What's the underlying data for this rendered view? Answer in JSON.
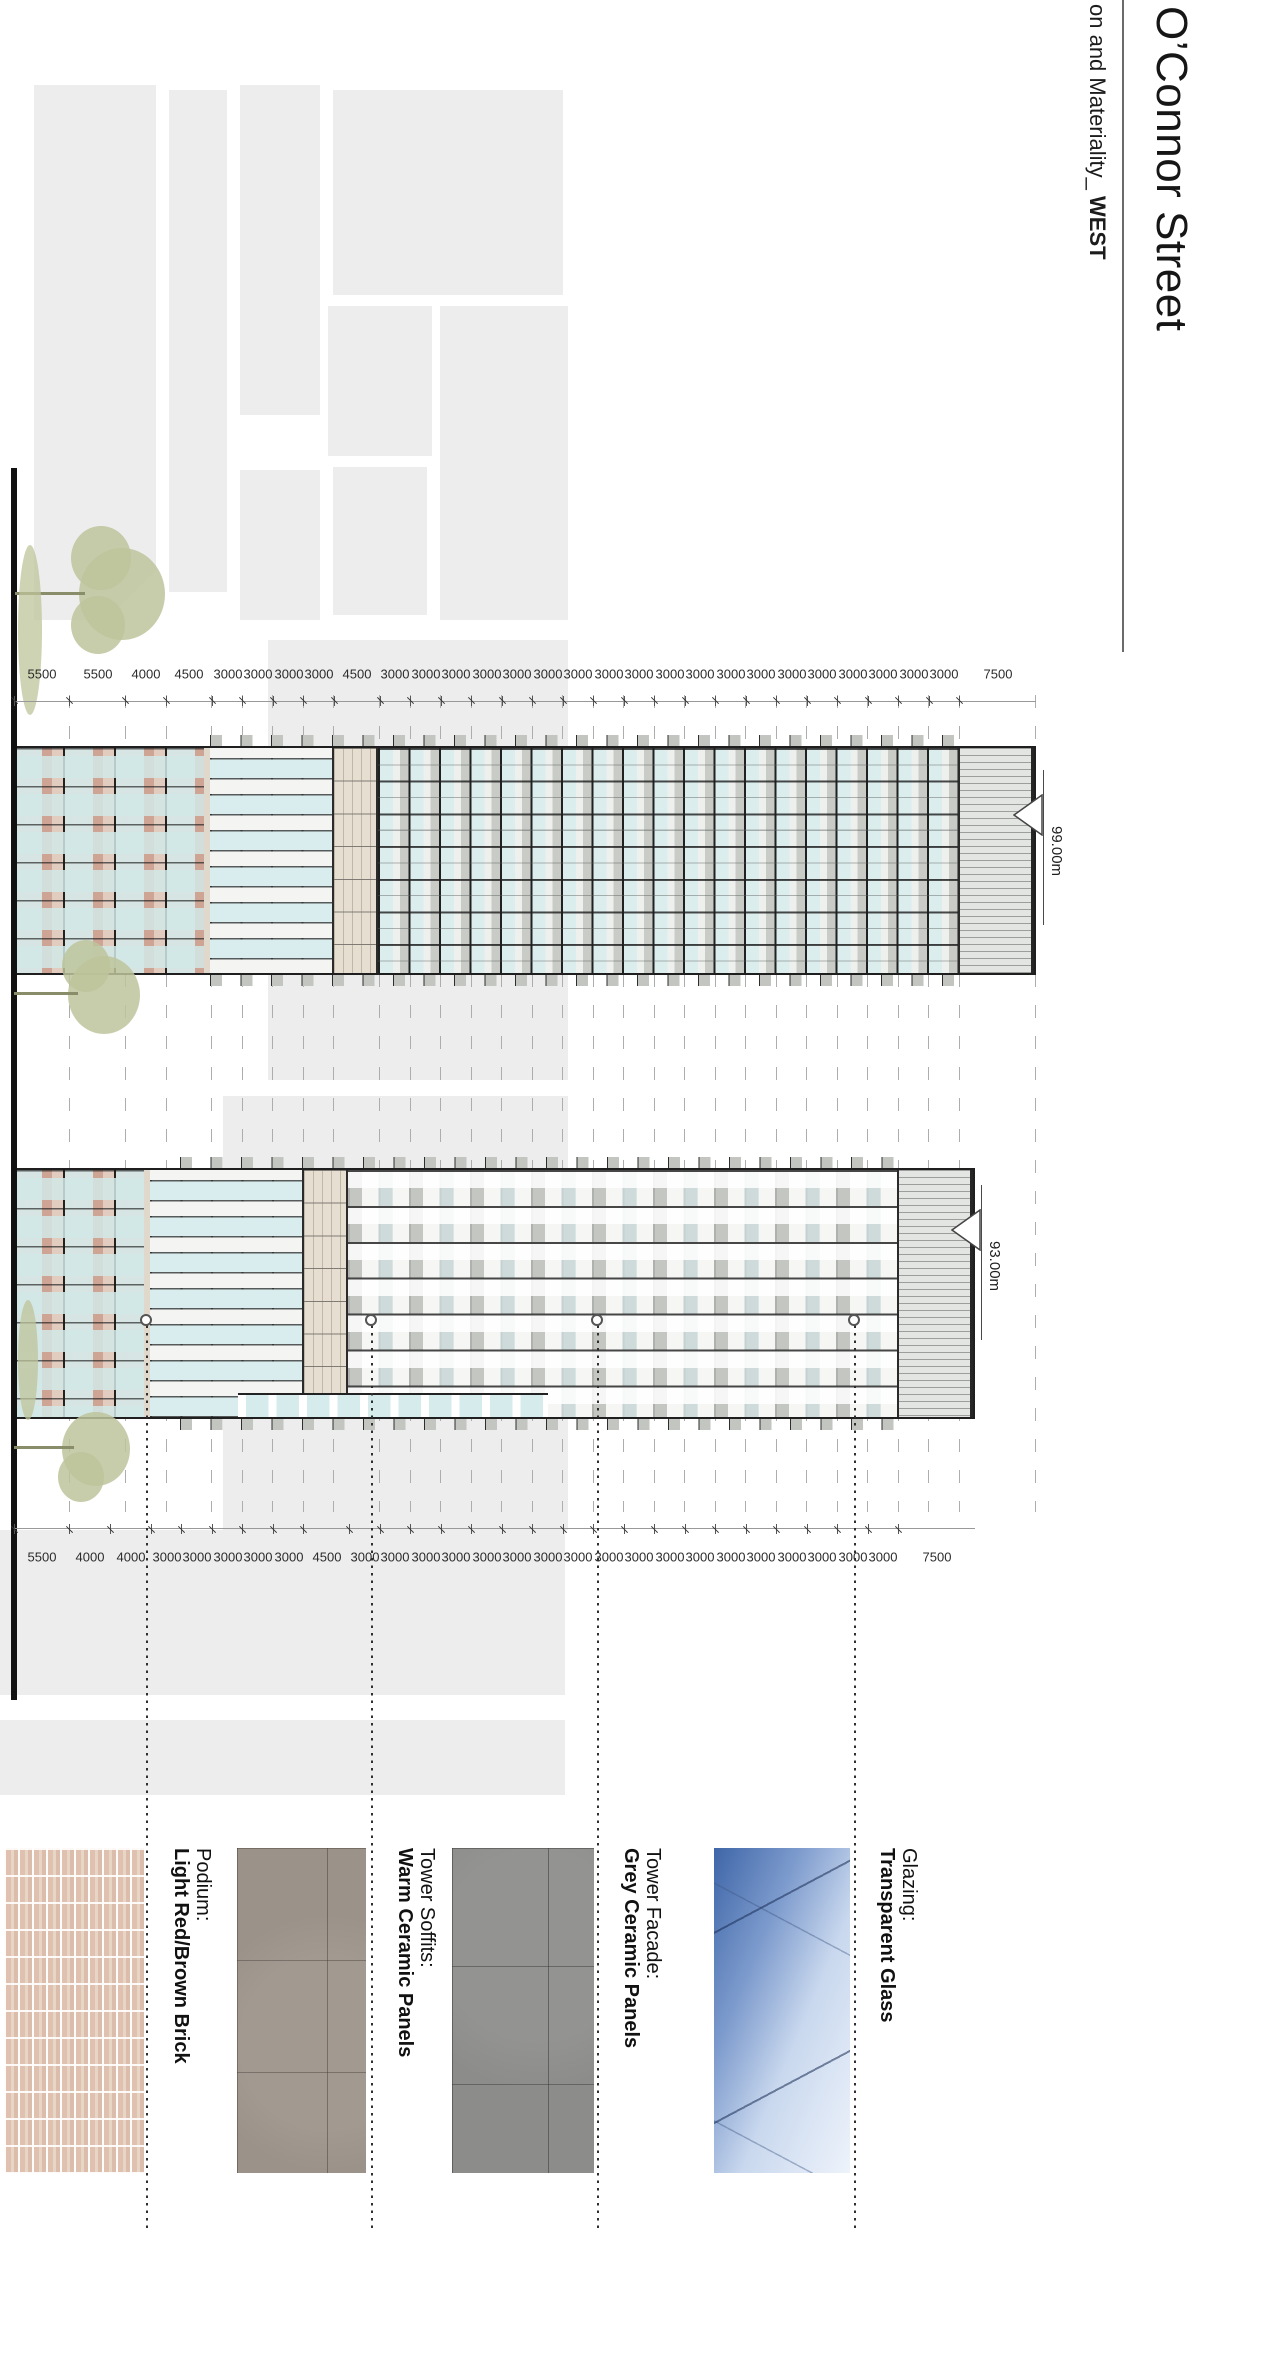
{
  "title": "O’Connor Street",
  "subtitle": {
    "prefix": "on and Materiality_ ",
    "bold": "WEST"
  },
  "levels": {
    "tower1": "99.00m",
    "tower2": "93.00m"
  },
  "dimensions": {
    "tower1_bottom_to_top": [
      "5500",
      "5500",
      "4000",
      "4500",
      "3000",
      "3000",
      "3000",
      "3000",
      "4500",
      "3000",
      "3000",
      "3000",
      "3000",
      "3000",
      "3000",
      "3000",
      "3000",
      "3000",
      "3000",
      "3000",
      "3000",
      "3000",
      "3000",
      "3000",
      "3000",
      "3000",
      "3000",
      "3000",
      "7500"
    ],
    "tower2_bottom_to_top": [
      "5500",
      "4000",
      "4000",
      "3000",
      "3000",
      "3000",
      "3000",
      "3000",
      "4500",
      "3000",
      "3000",
      "3000",
      "3000",
      "3000",
      "3000",
      "3000",
      "3000",
      "3000",
      "3000",
      "3000",
      "3000",
      "3000",
      "3000",
      "3000",
      "3000",
      "3000",
      "3000",
      "7500"
    ]
  },
  "legend": [
    {
      "label": "Glazing:",
      "material": "Transparent Glass"
    },
    {
      "label": "Tower Facade:",
      "material": "Grey Ceramic Panels"
    },
    {
      "label": "Tower Soffits:",
      "material": "Warm Ceramic Panels"
    },
    {
      "label": "Podium:",
      "material": "Light Red/Brown Brick"
    }
  ],
  "colors": {
    "plan_grey": "#ededee",
    "glazing_cyan": "#dcedee",
    "brick": "#dcc2b8",
    "warm_ceramic": "#9b9289",
    "grey_ceramic": "#8c8c8a",
    "glass_blue": "#3f66a8",
    "tree_olive": "#bdc49b",
    "ink": "#1f1f1f"
  }
}
